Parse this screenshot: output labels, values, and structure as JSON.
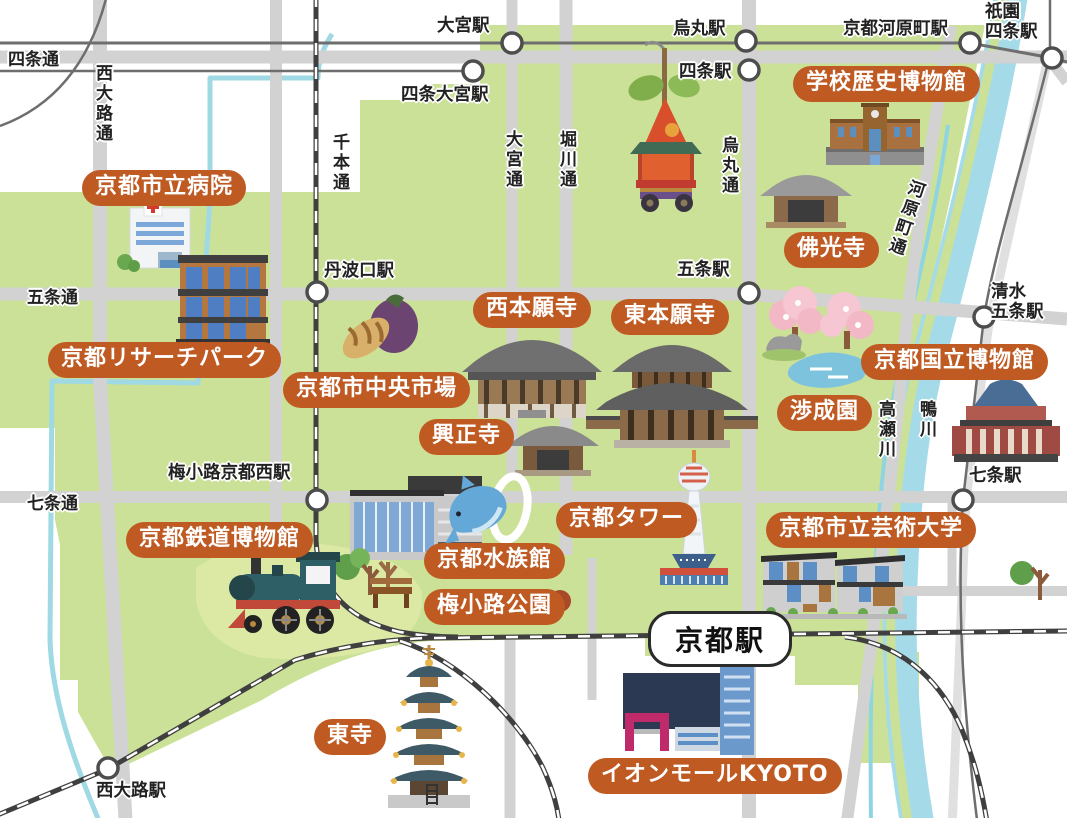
{
  "colors": {
    "land": "#cbe197",
    "hill": "#dce9a4",
    "road": "#d2d2d2",
    "road_east": "#e0e0e0",
    "rail_dark": "#3f3f3f",
    "rail_thin": "#6e6e6e",
    "river": "#a5dbe8",
    "badge_bg": "#bf5a22",
    "badge_text": "#ffffff",
    "label_text": "#222222"
  },
  "badges": [
    {
      "id": "school-history-museum",
      "label": "学校歴史博物館"
    },
    {
      "id": "city-hospital",
      "label": "京都市立病院"
    },
    {
      "id": "research-park",
      "label": "京都リサーチパーク"
    },
    {
      "id": "central-market",
      "label": "京都市中央市場"
    },
    {
      "id": "nishi-honganji",
      "label": "西本願寺"
    },
    {
      "id": "higashi-honganji",
      "label": "東本願寺"
    },
    {
      "id": "bukkoji",
      "label": "佛光寺"
    },
    {
      "id": "koshoji",
      "label": "興正寺"
    },
    {
      "id": "shoseien",
      "label": "渉成園"
    },
    {
      "id": "national-museum",
      "label": "京都国立博物館"
    },
    {
      "id": "kyoto-tower",
      "label": "京都タワー"
    },
    {
      "id": "aquarium",
      "label": "京都水族館"
    },
    {
      "id": "umekoji-park",
      "label": "梅小路公園"
    },
    {
      "id": "railway-museum",
      "label": "京都鉄道博物館"
    },
    {
      "id": "arts-university",
      "label": "京都市立芸術大学"
    },
    {
      "id": "toji",
      "label": "東寺"
    },
    {
      "id": "aeon-mall",
      "label": "イオンモールKYOTO"
    }
  ],
  "stations": [
    {
      "id": "omiya",
      "label": "大宮駅"
    },
    {
      "id": "shijo-omiya",
      "label": "四条大宮駅"
    },
    {
      "id": "karasuma",
      "label": "烏丸駅"
    },
    {
      "id": "shijo",
      "label": "四条駅"
    },
    {
      "id": "kyoto-kawaramachi",
      "label": "京都河原町駅"
    },
    {
      "id": "gion-shijo",
      "label": "祇園\n四条駅"
    },
    {
      "id": "tambaguchi",
      "label": "丹波口駅"
    },
    {
      "id": "gojo",
      "label": "五条駅"
    },
    {
      "id": "kiyomizu-gojo",
      "label": "清水\n五条駅"
    },
    {
      "id": "shichijo",
      "label": "七条駅"
    },
    {
      "id": "umekoji-kyotonishi",
      "label": "梅小路京都西駅"
    },
    {
      "id": "nishioji",
      "label": "西大路駅"
    }
  ],
  "kyoto_station": {
    "label": "京都駅"
  },
  "road_labels": [
    {
      "id": "shijo-dori",
      "label": "四条通"
    },
    {
      "id": "nishioji-dori",
      "label": "西大路通"
    },
    {
      "id": "senbon-dori",
      "label": "千本通"
    },
    {
      "id": "omiya-dori",
      "label": "大宮通"
    },
    {
      "id": "horikawa-dori",
      "label": "堀川通"
    },
    {
      "id": "karasuma-dori",
      "label": "烏丸通"
    },
    {
      "id": "gojo-dori",
      "label": "五条通"
    },
    {
      "id": "shichijo-dori",
      "label": "七条通"
    },
    {
      "id": "kawaramachi-dori",
      "label": "河原町通"
    }
  ],
  "water_labels": [
    {
      "id": "takase-river",
      "label": "高瀬川"
    },
    {
      "id": "kamo-river",
      "label": "鴨川"
    }
  ],
  "icons": [
    "gion-festival-float-icon",
    "school-building-icon",
    "bukkoji-temple-icon",
    "hospital-icon",
    "research-park-building-icon",
    "vegetables-icon",
    "nishi-honganji-temple-icon",
    "higashi-honganji-temple-icon",
    "koshoji-temple-icon",
    "cherry-blossom-icon",
    "pond-icon",
    "national-museum-building-icon",
    "kyoto-tower-icon",
    "aquarium-building-icon",
    "dolphin-icon",
    "bench-icon",
    "tree-icon",
    "steam-locomotive-icon",
    "university-building-icon",
    "pagoda-icon",
    "shopping-mall-icon"
  ]
}
